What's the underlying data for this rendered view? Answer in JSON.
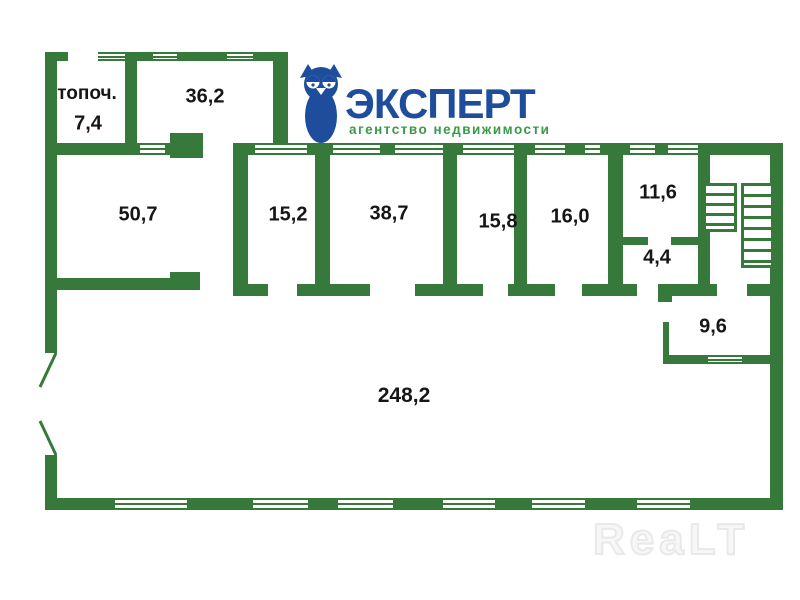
{
  "colors": {
    "wall": "#37793B",
    "label": "#161616",
    "logo_blue": "#1e4d9c",
    "logo_green": "#3a9a49",
    "watermark": "#e9e9e9"
  },
  "plan": {
    "rooms": [
      {
        "id": "topoch",
        "label": "топоч.",
        "area": "7,4"
      },
      {
        "id": "room-36-2",
        "area": "36,2"
      },
      {
        "id": "room-50-7",
        "area": "50,7"
      },
      {
        "id": "room-15-2",
        "area": "15,2"
      },
      {
        "id": "room-38-7",
        "area": "38,7"
      },
      {
        "id": "room-15-8",
        "area": "15,8"
      },
      {
        "id": "room-16-0",
        "area": "16,0"
      },
      {
        "id": "room-11-6",
        "area": "11,6"
      },
      {
        "id": "room-4-4",
        "area": "4,4"
      },
      {
        "id": "room-9-6",
        "area": "9,6"
      },
      {
        "id": "hall-248-2",
        "area": "248,2"
      }
    ]
  },
  "logo": {
    "title": "ЭКСПЕРТ",
    "subtitle": "агентство недвижимости"
  },
  "watermark": {
    "text": "ReaLT"
  }
}
